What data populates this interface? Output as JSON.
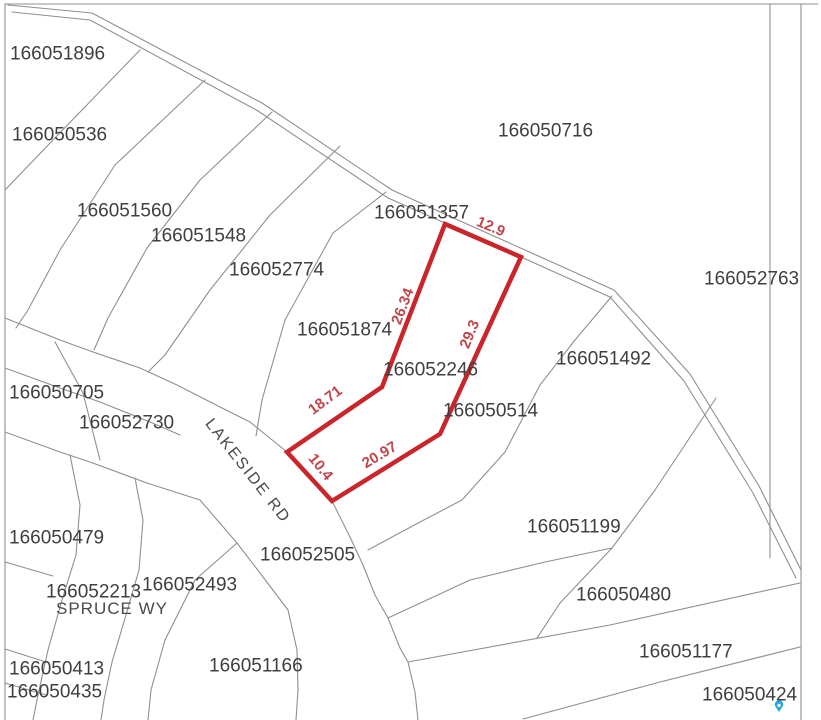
{
  "map": {
    "width": 821,
    "height": 720,
    "background": "#ffffff",
    "line_color": "#8f8f8f",
    "label_color": "#3f3f3f",
    "highlight_color": "#c9252b",
    "dimension_color": "#c2454b",
    "pin_color": "#2aa7df"
  },
  "parcel_labels": [
    {
      "id": "166051896",
      "x": 10,
      "y": 45
    },
    {
      "id": "166050536",
      "x": 12,
      "y": 126
    },
    {
      "id": "166051560",
      "x": 77,
      "y": 202
    },
    {
      "id": "166051548",
      "x": 151,
      "y": 227
    },
    {
      "id": "166052774",
      "x": 229,
      "y": 261
    },
    {
      "id": "166050716",
      "x": 498,
      "y": 122
    },
    {
      "id": "166051357",
      "x": 374,
      "y": 204
    },
    {
      "id": "166052763",
      "x": 704,
      "y": 270
    },
    {
      "id": "166051874",
      "x": 297,
      "y": 321
    },
    {
      "id": "166052246",
      "x": 383,
      "y": 361
    },
    {
      "id": "166051492",
      "x": 556,
      "y": 350
    },
    {
      "id": "166050514",
      "x": 443,
      "y": 402
    },
    {
      "id": "166050705",
      "x": 9,
      "y": 384
    },
    {
      "id": "166052730",
      "x": 79,
      "y": 414
    },
    {
      "id": "166051199",
      "x": 527,
      "y": 518
    },
    {
      "id": "166050479",
      "x": 9,
      "y": 529
    },
    {
      "id": "166052505",
      "x": 260,
      "y": 546
    },
    {
      "id": "166052493",
      "x": 142,
      "y": 576
    },
    {
      "id": "166052213",
      "x": 46,
      "y": 583
    },
    {
      "id": "166050413",
      "x": 9,
      "y": 660
    },
    {
      "id": "166050435",
      "x": 7,
      "y": 683
    },
    {
      "id": "166051166",
      "x": 209,
      "y": 657
    },
    {
      "id": "166050480",
      "x": 576,
      "y": 586
    },
    {
      "id": "166051177",
      "x": 639,
      "y": 643
    },
    {
      "id": "166050424",
      "x": 702,
      "y": 686
    }
  ],
  "street_labels": [
    {
      "name": "LAKESIDE RD",
      "x": 244,
      "y": 474,
      "angle": 52,
      "class": "lakeside"
    },
    {
      "name": "SPRUCE WY",
      "x": 56,
      "y": 614,
      "angle": 0,
      "class": "spruce"
    }
  ],
  "highlighted_parcel": {
    "id": "166052246",
    "vertices": [
      [
        445,
        224
      ],
      [
        521,
        257
      ],
      [
        440,
        434
      ],
      [
        332,
        501
      ],
      [
        287,
        452
      ],
      [
        382,
        387
      ]
    ],
    "dimensions": [
      {
        "value": "12.9",
        "x": 489,
        "y": 231,
        "angle": 23
      },
      {
        "value": "26.34",
        "x": 407,
        "y": 308,
        "angle": -69
      },
      {
        "value": "29.3",
        "x": 474,
        "y": 336,
        "angle": -68
      },
      {
        "value": "18.71",
        "x": 328,
        "y": 404,
        "angle": -37
      },
      {
        "value": "20.97",
        "x": 382,
        "y": 459,
        "angle": -31
      },
      {
        "value": "10.4",
        "x": 317,
        "y": 470,
        "angle": 51
      }
    ]
  },
  "map_lines": [
    {
      "name": "frame-top",
      "points": [
        [
          5,
          4
        ],
        [
          818,
          4
        ]
      ]
    },
    {
      "name": "frame-left",
      "points": [
        [
          5,
          4
        ],
        [
          5,
          720
        ]
      ]
    },
    {
      "name": "right-road-west-edge",
      "points": [
        [
          770,
          4
        ],
        [
          770,
          558
        ]
      ]
    },
    {
      "name": "right-road-east-edge",
      "points": [
        [
          801,
          4
        ],
        [
          801,
          720
        ]
      ]
    },
    {
      "name": "main-road-north-edge",
      "points": [
        [
          8,
          5
        ],
        [
          92,
          13
        ],
        [
          262,
          103
        ],
        [
          392,
          190
        ],
        [
          449,
          216
        ],
        [
          525,
          250
        ],
        [
          614,
          290
        ],
        [
          690,
          374
        ],
        [
          759,
          486
        ],
        [
          801,
          570
        ]
      ]
    },
    {
      "name": "main-road-south-edge",
      "points": [
        [
          12,
          12
        ],
        [
          90,
          20
        ],
        [
          258,
          111
        ],
        [
          388,
          198
        ],
        [
          445,
          223
        ],
        [
          521,
          257
        ],
        [
          610,
          297
        ],
        [
          684,
          381
        ],
        [
          753,
          493
        ],
        [
          796,
          578
        ]
      ]
    },
    {
      "name": "lot-line-p1",
      "points": [
        [
          140,
          50
        ],
        [
          53,
          140
        ],
        [
          5,
          190
        ]
      ]
    },
    {
      "name": "lot-line-p2",
      "points": [
        [
          205,
          80
        ],
        [
          115,
          165
        ],
        [
          60,
          250
        ],
        [
          28,
          310
        ],
        [
          16,
          328
        ]
      ]
    },
    {
      "name": "lot-line-p3",
      "points": [
        [
          272,
          112
        ],
        [
          200,
          180
        ],
        [
          147,
          248
        ],
        [
          108,
          318
        ],
        [
          94,
          350
        ]
      ]
    },
    {
      "name": "lot-line-p4",
      "points": [
        [
          340,
          146
        ],
        [
          270,
          215
        ],
        [
          210,
          290
        ],
        [
          165,
          355
        ],
        [
          148,
          372
        ]
      ]
    },
    {
      "name": "lot-line-p5",
      "points": [
        [
          386,
          192
        ],
        [
          333,
          233
        ],
        [
          285,
          320
        ],
        [
          262,
          400
        ],
        [
          256,
          436
        ]
      ]
    },
    {
      "name": "lakeside-north-edge",
      "points": [
        [
          5,
          318
        ],
        [
          60,
          340
        ],
        [
          93,
          352
        ],
        [
          140,
          368
        ],
        [
          177,
          385
        ],
        [
          222,
          408
        ],
        [
          250,
          422
        ],
        [
          287,
          452
        ]
      ]
    },
    {
      "name": "lakeside-east-edge",
      "points": [
        [
          332,
          501
        ],
        [
          350,
          537
        ],
        [
          363,
          565
        ],
        [
          375,
          595
        ],
        [
          388,
          618
        ],
        [
          400,
          648
        ],
        [
          408,
          662
        ],
        [
          415,
          692
        ],
        [
          418,
          720
        ]
      ]
    },
    {
      "name": "lakeside-mid-line",
      "points": [
        [
          5,
          368
        ],
        [
          60,
          388
        ],
        [
          100,
          402
        ],
        [
          150,
          422
        ],
        [
          180,
          435
        ]
      ]
    },
    {
      "name": "lot-line-705-2730",
      "points": [
        [
          55,
          342
        ],
        [
          83,
          393
        ],
        [
          100,
          460
        ]
      ]
    },
    {
      "name": "lakeside-south-edge",
      "points": [
        [
          5,
          432
        ],
        [
          60,
          452
        ],
        [
          90,
          462
        ],
        [
          147,
          483
        ],
        [
          200,
          500
        ],
        [
          237,
          543
        ],
        [
          260,
          573
        ],
        [
          288,
          610
        ],
        [
          297,
          650
        ],
        [
          298,
          690
        ],
        [
          296,
          720
        ]
      ]
    },
    {
      "name": "spruce-west-edge",
      "points": [
        [
          70,
          455
        ],
        [
          80,
          505
        ],
        [
          76,
          555
        ],
        [
          62,
          600
        ],
        [
          48,
          650
        ],
        [
          38,
          695
        ],
        [
          33,
          720
        ]
      ]
    },
    {
      "name": "spruce-east-edge",
      "points": [
        [
          135,
          478
        ],
        [
          143,
          520
        ],
        [
          139,
          570
        ],
        [
          126,
          615
        ],
        [
          112,
          662
        ],
        [
          104,
          700
        ],
        [
          101,
          720
        ]
      ]
    },
    {
      "name": "lot-line-2493",
      "points": [
        [
          237,
          543
        ],
        [
          195,
          580
        ],
        [
          165,
          640
        ],
        [
          151,
          690
        ],
        [
          148,
          720
        ]
      ]
    },
    {
      "name": "lot-line-479-south",
      "points": [
        [
          5,
          562
        ],
        [
          53,
          576
        ]
      ]
    },
    {
      "name": "lot-line-413-north",
      "points": [
        [
          5,
          649
        ],
        [
          49,
          663
        ]
      ]
    },
    {
      "name": "lot-line-413-435",
      "points": [
        [
          5,
          683
        ],
        [
          46,
          695
        ]
      ]
    },
    {
      "name": "lot-line-1492-west",
      "points": [
        [
          612,
          296
        ],
        [
          575,
          340
        ],
        [
          540,
          385
        ],
        [
          505,
          452
        ],
        [
          462,
          500
        ],
        [
          420,
          522
        ],
        [
          368,
          550
        ]
      ]
    },
    {
      "name": "lot-line-1199-east",
      "points": [
        [
          716,
          398
        ],
        [
          655,
          490
        ],
        [
          612,
          548
        ],
        [
          560,
          603
        ],
        [
          537,
          638
        ]
      ]
    },
    {
      "name": "lot-line-1199-south",
      "points": [
        [
          388,
          618
        ],
        [
          470,
          580
        ],
        [
          545,
          562
        ],
        [
          612,
          548
        ]
      ]
    },
    {
      "name": "lot-line-480-south",
      "points": [
        [
          408,
          662
        ],
        [
          610,
          625
        ],
        [
          800,
          583
        ]
      ]
    },
    {
      "name": "lot-line-1177-south",
      "points": [
        [
          523,
          719
        ],
        [
          660,
          682
        ],
        [
          800,
          647
        ]
      ]
    }
  ],
  "marker": {
    "name": "location-pin",
    "x": 779,
    "y": 710
  }
}
